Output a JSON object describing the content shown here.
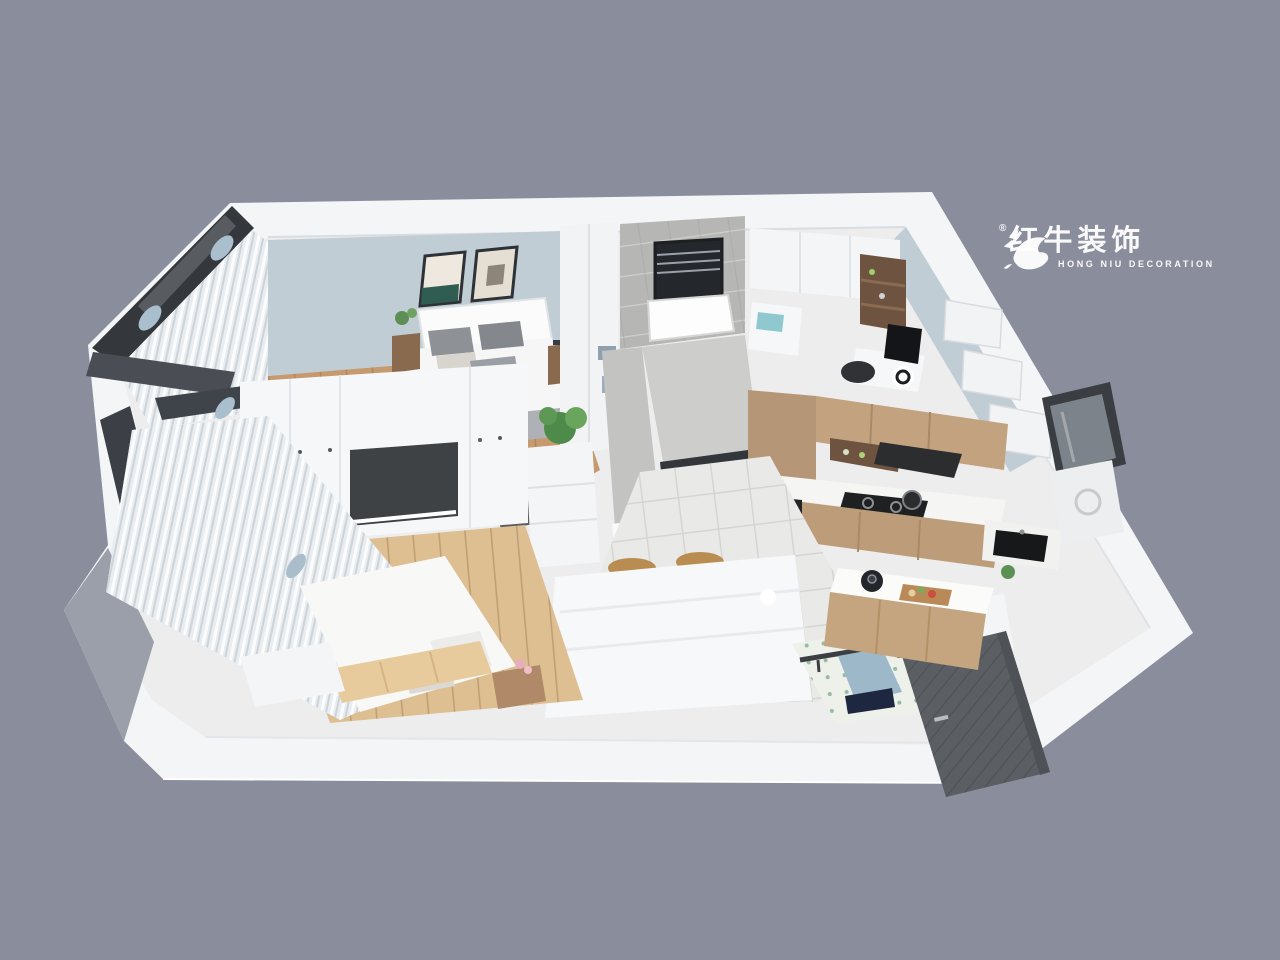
{
  "watermark": {
    "brand_cn": "红牛装饰",
    "brand_en": "HONG NIU DECORATION",
    "registered": "®"
  },
  "scene": {
    "colors": {
      "background": "#8a8d9c",
      "wall_white": "#f3f5f7",
      "wall_blue": "#c1cdd4",
      "marble_gray": "#b6b6b4",
      "floor_wood": "#c59a6e",
      "floor_wood_light": "#ddbf92",
      "floor_tile": "#e9eae7",
      "cabinet_wood": "#c2a27f",
      "counter_white": "#f5f5f3",
      "appliance_black": "#1e2022",
      "frame_dark": "#34373c",
      "door_gray": "#5b5f63",
      "curtain_white": "#edf0f2",
      "accent_teal": "#79b1b5",
      "accent_blue": "#9db9c9"
    }
  }
}
